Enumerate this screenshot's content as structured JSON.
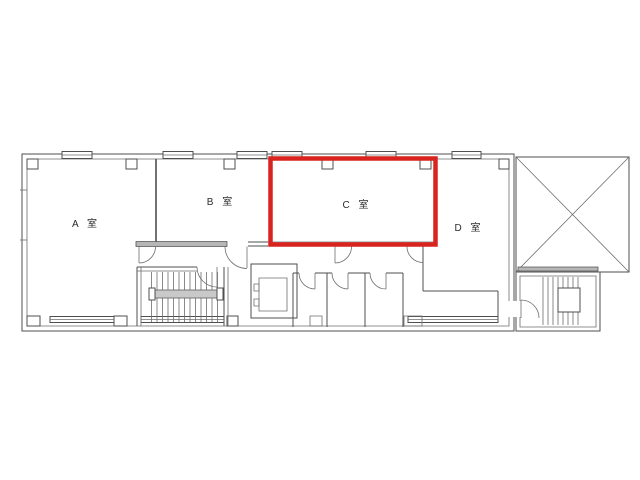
{
  "canvas": {
    "background_color": "#ffffff",
    "width_px": 640,
    "height_px": 480
  },
  "floor_plan": {
    "kind": "building-floor-plan",
    "highlight_color": "#d9231f",
    "wall_color": "#4f4f4f",
    "rooms": [
      {
        "id": "a",
        "label": "A 室",
        "highlighted": false
      },
      {
        "id": "b",
        "label": "B 室",
        "highlighted": false
      },
      {
        "id": "c",
        "label": "C 室",
        "highlighted": true
      },
      {
        "id": "d",
        "label": "D 室",
        "highlighted": false
      }
    ],
    "highlighted_room_label": "C 室",
    "feature_icons": [
      "stairwell-left-icon",
      "elevator-icon",
      "toilet-stalls-icon",
      "stairwell-right-icon",
      "void-x-area-icon",
      "window-icon",
      "door-arc-icon",
      "column-mark-icon"
    ]
  }
}
